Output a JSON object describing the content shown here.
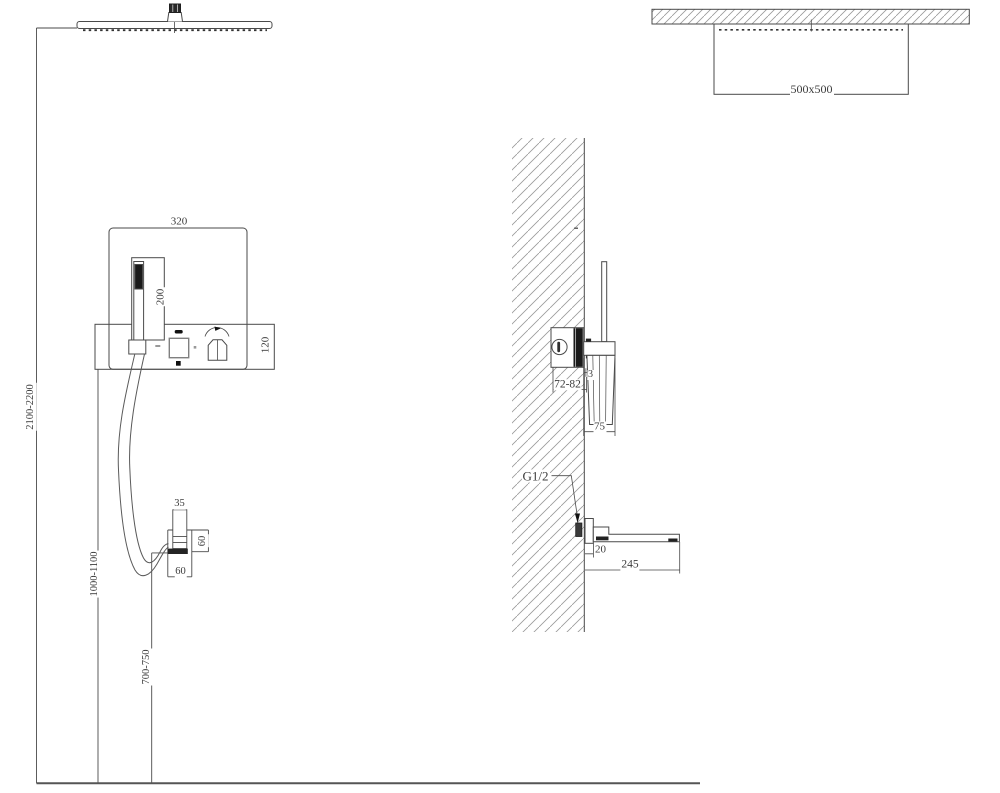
{
  "drawing_type": "shower-system-installation-diagram",
  "colors": {
    "line": "#4a4a4a",
    "thin_line": "#6a6a6a",
    "dark_fill": "#1f1f1f",
    "hatch": "#9a9a9a",
    "text": "#3c3c3c",
    "background": "#ffffff"
  },
  "front_view": {
    "panel_width_dim": "320",
    "handshower_recess_dim": "200",
    "panel_band_height_dim": "120",
    "shower_head_height_dim": "2100-2200",
    "panel_mount_height_dim": "1000-1100",
    "hose_outlet_height_dim": "700-750",
    "outlet_width_dim": "35",
    "outlet_height_dim": "60",
    "outlet_base_dim": "60"
  },
  "side_view": {
    "head_size_dim": "500x500",
    "valve_depth_dim": "72-82",
    "trim_offset_dim": "3",
    "handshower_depth_dim": "75",
    "thread_label": "G1/2",
    "spout_plate_dim": "20",
    "spout_length_dim": "245"
  }
}
